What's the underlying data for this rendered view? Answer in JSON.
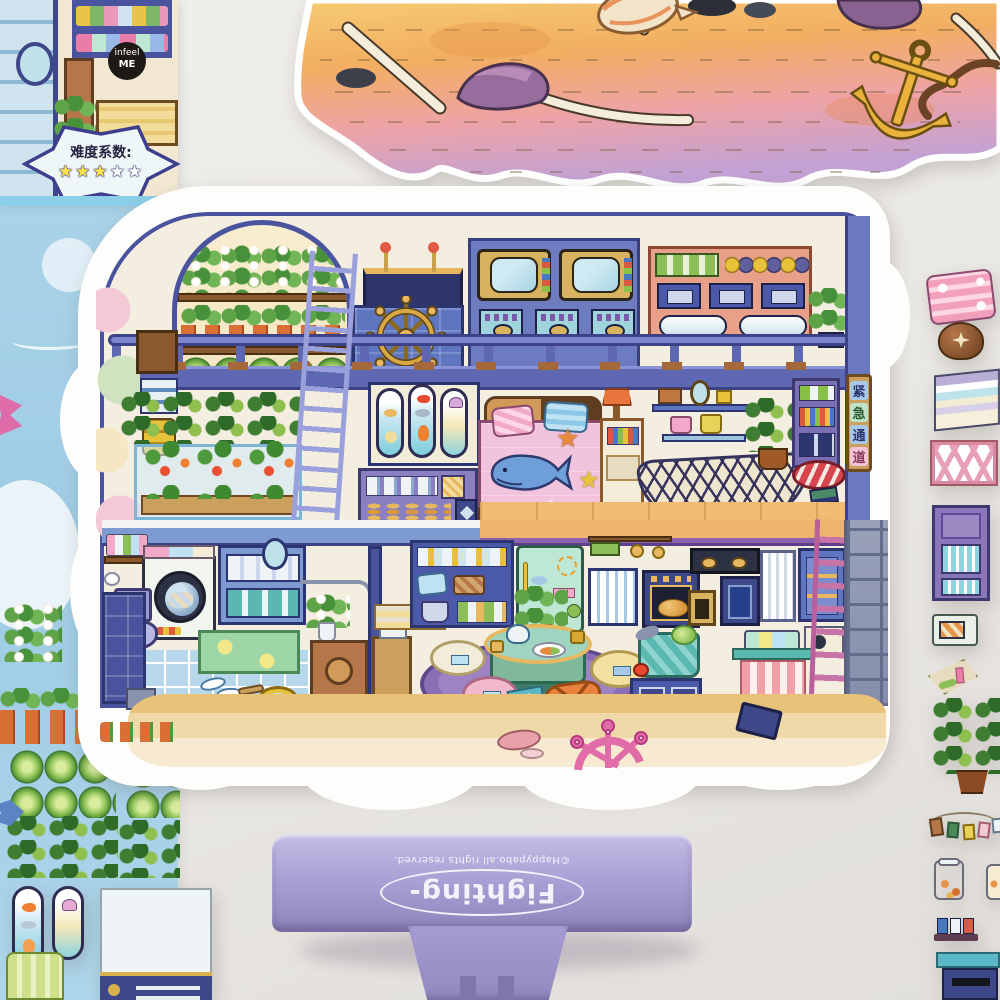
{
  "top_left_sheet": {
    "badge_line1": "infeel",
    "badge_line2": "ME",
    "difficulty_label": "难度系数:",
    "stars_filled": "★★★",
    "stars_empty": "★★"
  },
  "house_sticker": {
    "sign_chars": [
      "紧",
      "急",
      "通",
      "道"
    ]
  },
  "clip": {
    "brand": "Fighting-",
    "copyright": "©Happypabo.all rights reserved."
  },
  "icons": {
    "starfish_glyph": "★"
  },
  "palette": {
    "clip_purple": "#aba1d6",
    "house_trim_blue": "#4a539e",
    "sheet_blue": "#a9d3e8",
    "sand_orange": "#f2ae62",
    "sand_pink": "#eda3a8",
    "sand_purple": "#c3a3d4",
    "star_yellow": "#ffe34d",
    "mint_fridge": "#bfe8d4"
  }
}
